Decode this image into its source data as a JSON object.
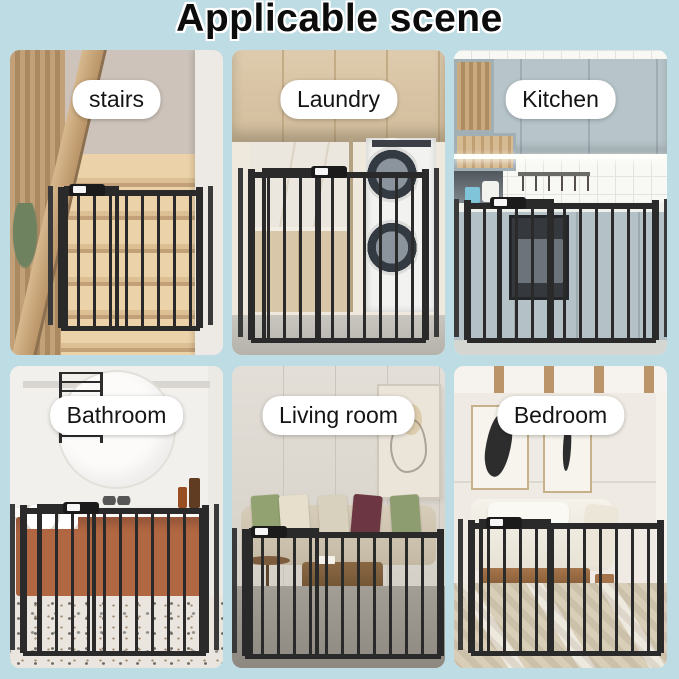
{
  "header": {
    "title": "Applicable scene"
  },
  "panels": [
    {
      "id": "stairs",
      "label": "stairs"
    },
    {
      "id": "laundry",
      "label": "Laundry"
    },
    {
      "id": "kitchen",
      "label": "Kitchen"
    },
    {
      "id": "bathroom",
      "label": "Bathroom"
    },
    {
      "id": "living-room",
      "label": "Living room"
    },
    {
      "id": "bedroom",
      "label": "Bedroom"
    }
  ],
  "colors": {
    "background": "#bedce3",
    "title_text": "#0c0c0c",
    "label_background": "#ffffff",
    "label_text": "#141414",
    "gate": "#2a2a2a"
  }
}
